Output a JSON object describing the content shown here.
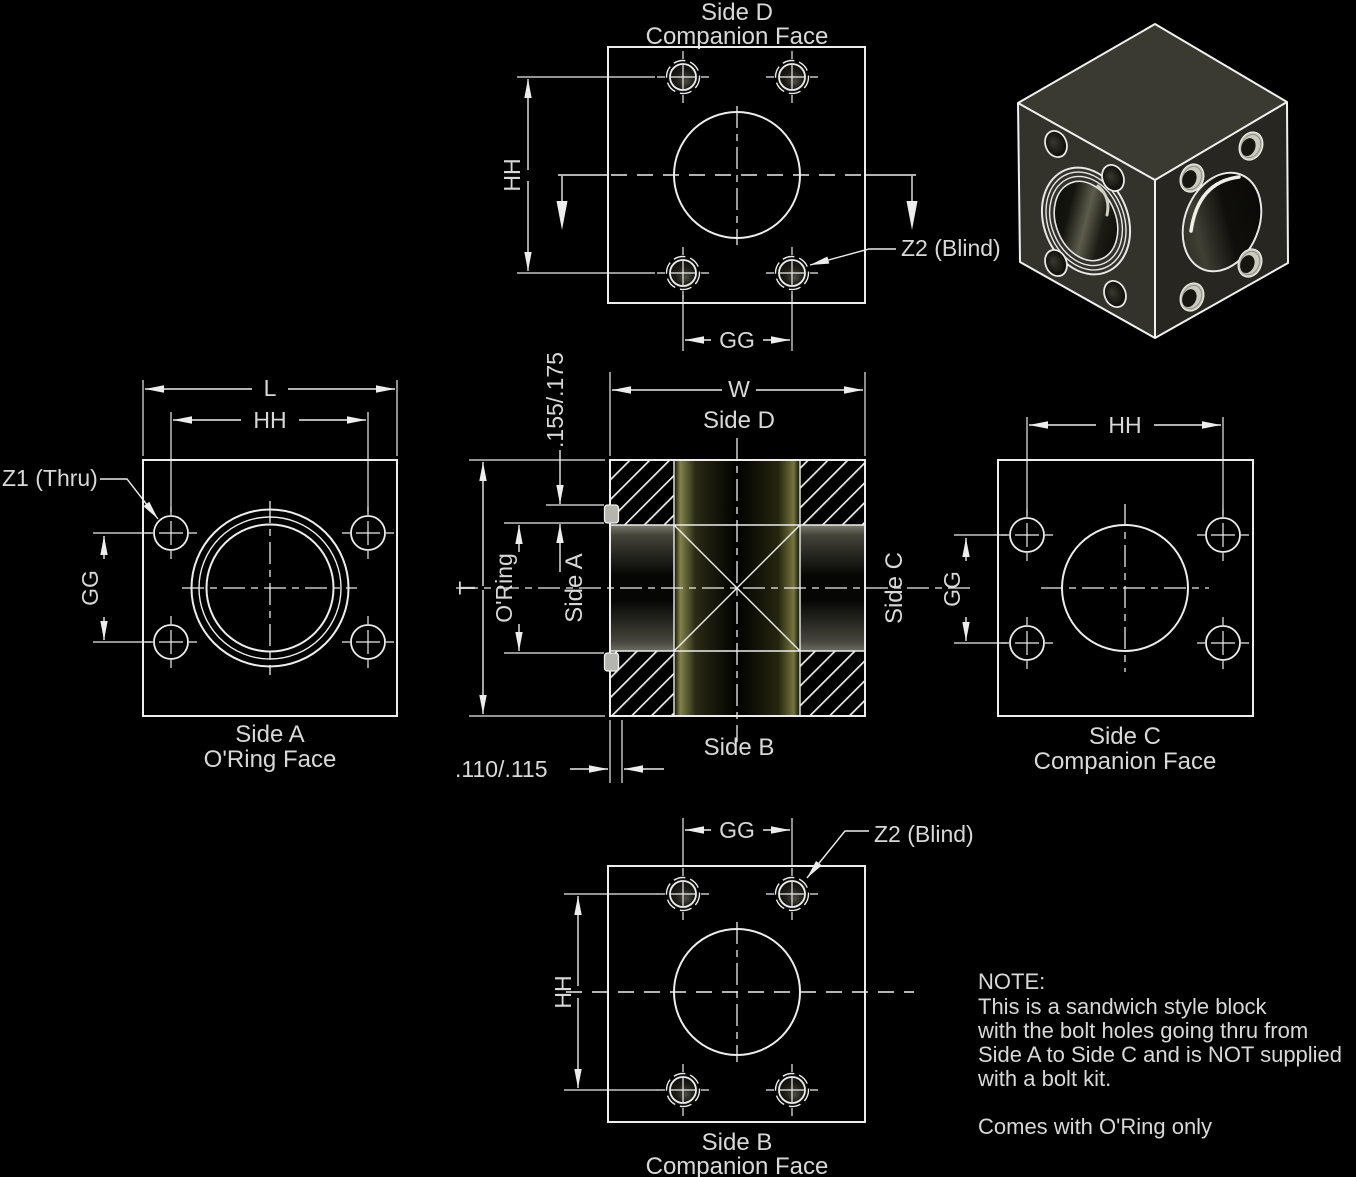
{
  "colors": {
    "background": "#000000",
    "line": "#ededed",
    "text": "#d8d8d8"
  },
  "views": {
    "side_d_top": {
      "title": "Side D",
      "subtitle": "Companion Face",
      "dim_hh": "HH",
      "dim_gg": "GG",
      "callout_z2": "Z2 (Blind)"
    },
    "side_a": {
      "title": "Side A",
      "subtitle": "O'Ring Face",
      "dim_l": "L",
      "dim_hh": "HH",
      "dim_gg": "GG",
      "callout_z1": "Z1 (Thru)"
    },
    "section": {
      "dim_w": "W",
      "dim_t": "T",
      "label_side_d": "Side D",
      "label_side_b": "Side B",
      "label_side_a": "Side A",
      "label_side_c": "Side C",
      "label_oring": "O'Ring",
      "dim_groove_width": ".155/.175",
      "dim_groove_depth": ".110/.115"
    },
    "side_c": {
      "title": "Side C",
      "subtitle": "Companion Face",
      "dim_hh": "HH",
      "dim_gg": "GG"
    },
    "side_b": {
      "title": "Side B",
      "subtitle": "Companion Face",
      "dim_hh": "HH",
      "dim_gg": "GG",
      "callout_z2": "Z2 (Blind)"
    }
  },
  "note": {
    "title": "NOTE:",
    "line1": "This is a sandwich style block",
    "line2": "with the bolt holes going thru from",
    "line3": "Side A to Side C and is NOT supplied",
    "line4": "with a bolt kit.",
    "line5": "Comes with O'Ring only"
  }
}
